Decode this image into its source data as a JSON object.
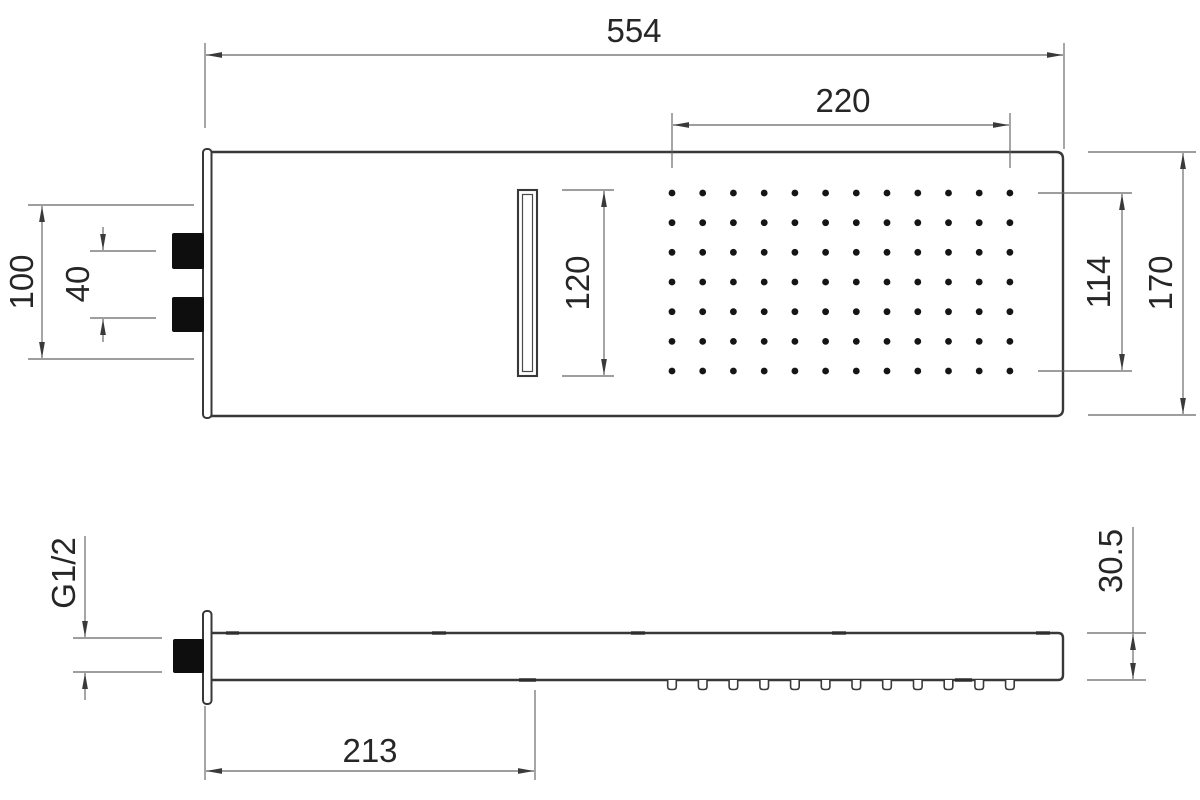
{
  "drawing": {
    "type": "technical-dimension-drawing",
    "views": {
      "front": "front view of rectangular shower head",
      "side": "side profile view"
    },
    "colors": {
      "background": "#ffffff",
      "object_line": "#383838",
      "dimension_line": "#636363",
      "text": "#262626",
      "solid_fill": "#0e0e0e"
    }
  },
  "dimensions": {
    "overall_width": "554",
    "spray_field_width": "220",
    "slot_height": "120",
    "spray_field_height": "114",
    "overall_height": "170",
    "mount_span": "100",
    "port_spacing": "40",
    "thread_size": "G1/2",
    "arm_length": "213",
    "body_thickness": "30.5"
  },
  "nozzle_grid": {
    "columns": 12,
    "rows": 7
  },
  "side_nozzles": {
    "count": 12
  }
}
